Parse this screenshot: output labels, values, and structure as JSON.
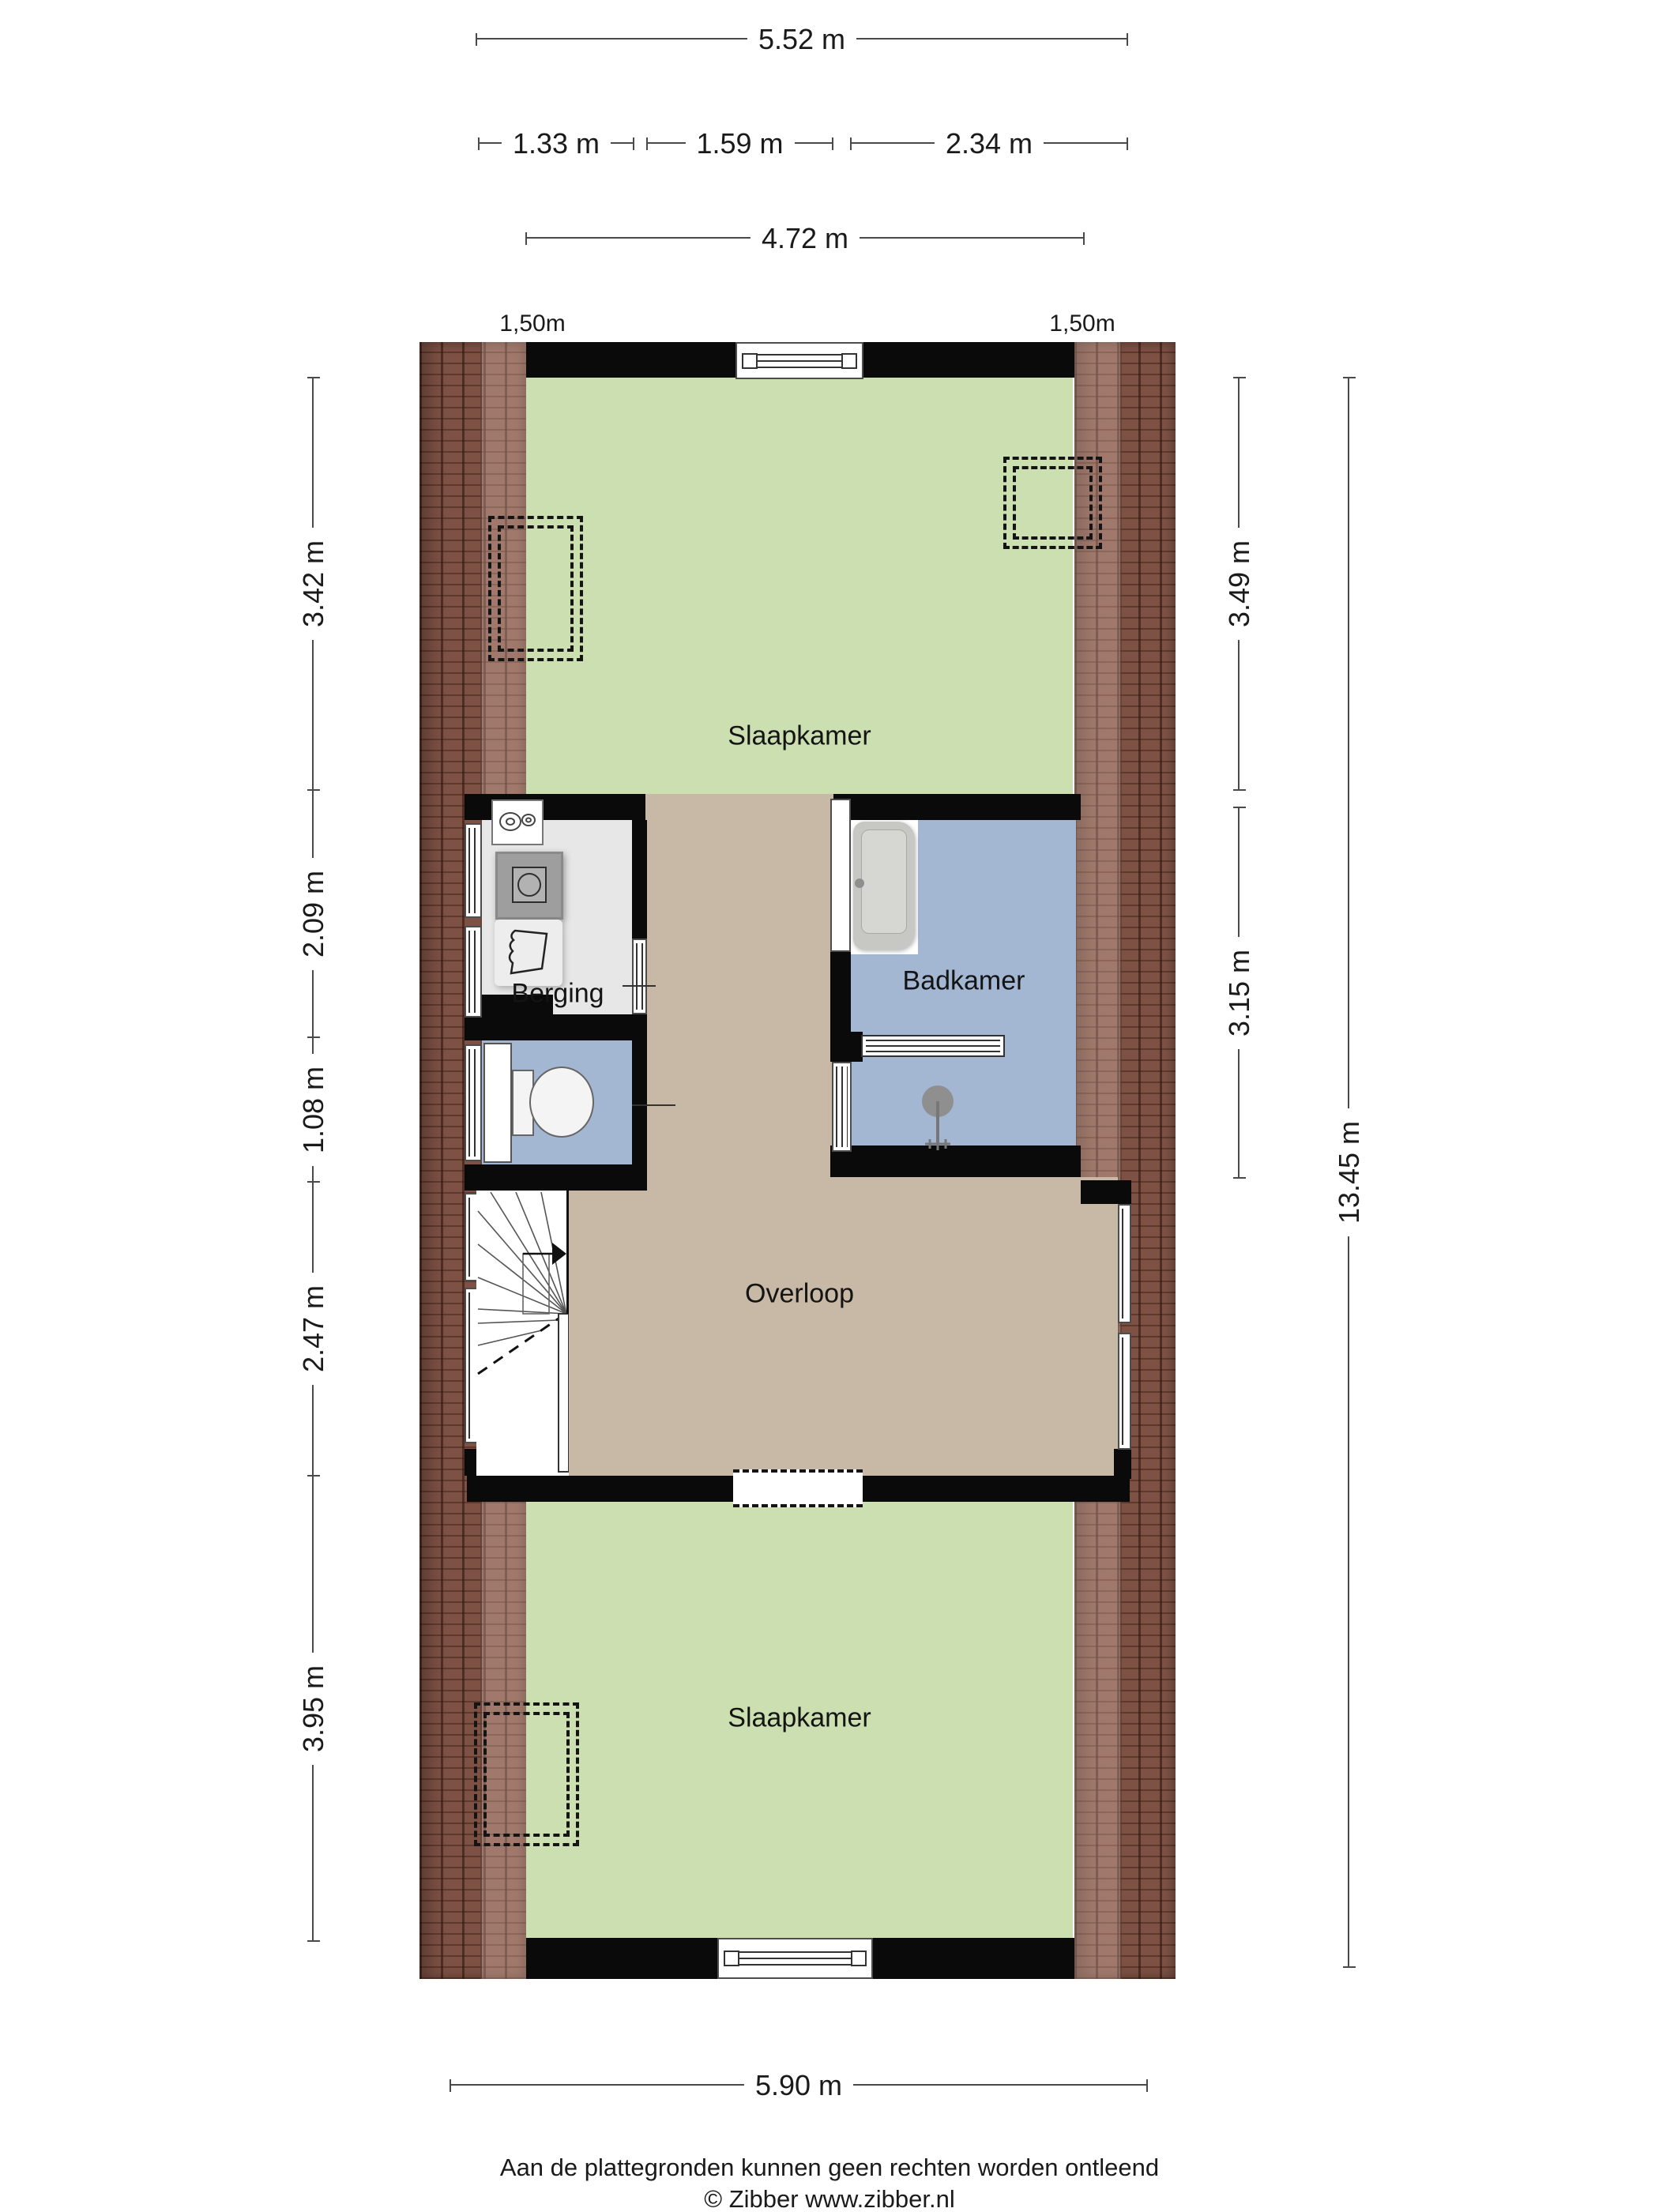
{
  "rooms": {
    "bedroom_top": "Slaapkamer",
    "storage": "Berging",
    "bathroom": "Badkamer",
    "landing": "Overloop",
    "bedroom_bottom": "Slaapkamer"
  },
  "dims": {
    "top_total": "5.52 m",
    "seg_a": "1.33 m",
    "seg_b": "1.59 m",
    "seg_c": "2.34 m",
    "top_inner": "4.72 m",
    "left": [
      "3.42 m",
      "2.09 m",
      "1.08 m",
      "2.47 m",
      "3.95 m"
    ],
    "right": [
      "3.49 m",
      "3.15 m"
    ],
    "right_total": "13.45 m",
    "bottom_total": "5.90 m"
  },
  "roof_height_marks": {
    "left": "1,50m",
    "right": "1,50m"
  },
  "footer": {
    "disclaimer": "Aan de plattegronden kunnen geen rechten worden ontleend",
    "copyright": "© Zibber www.zibber.nl"
  },
  "icons": [
    "bathtub-icon",
    "shower-icon",
    "toilet-icon",
    "washing-machine-icon",
    "laundry-basket-icon",
    "ventilation-unit-icon",
    "radiator-icon",
    "staircase-icon",
    "skylight-dashed-box",
    "window",
    "door"
  ],
  "colors": {
    "floor_bedroom": "#ccdfb0",
    "floor_landing": "#c7b9a5",
    "floor_bath": "#a3b7d3",
    "floor_storage": "#e7e7e7",
    "roof_brick": "#7d5144",
    "wall": "#0a0a0a",
    "dimension_line": "#4a4a4a"
  }
}
